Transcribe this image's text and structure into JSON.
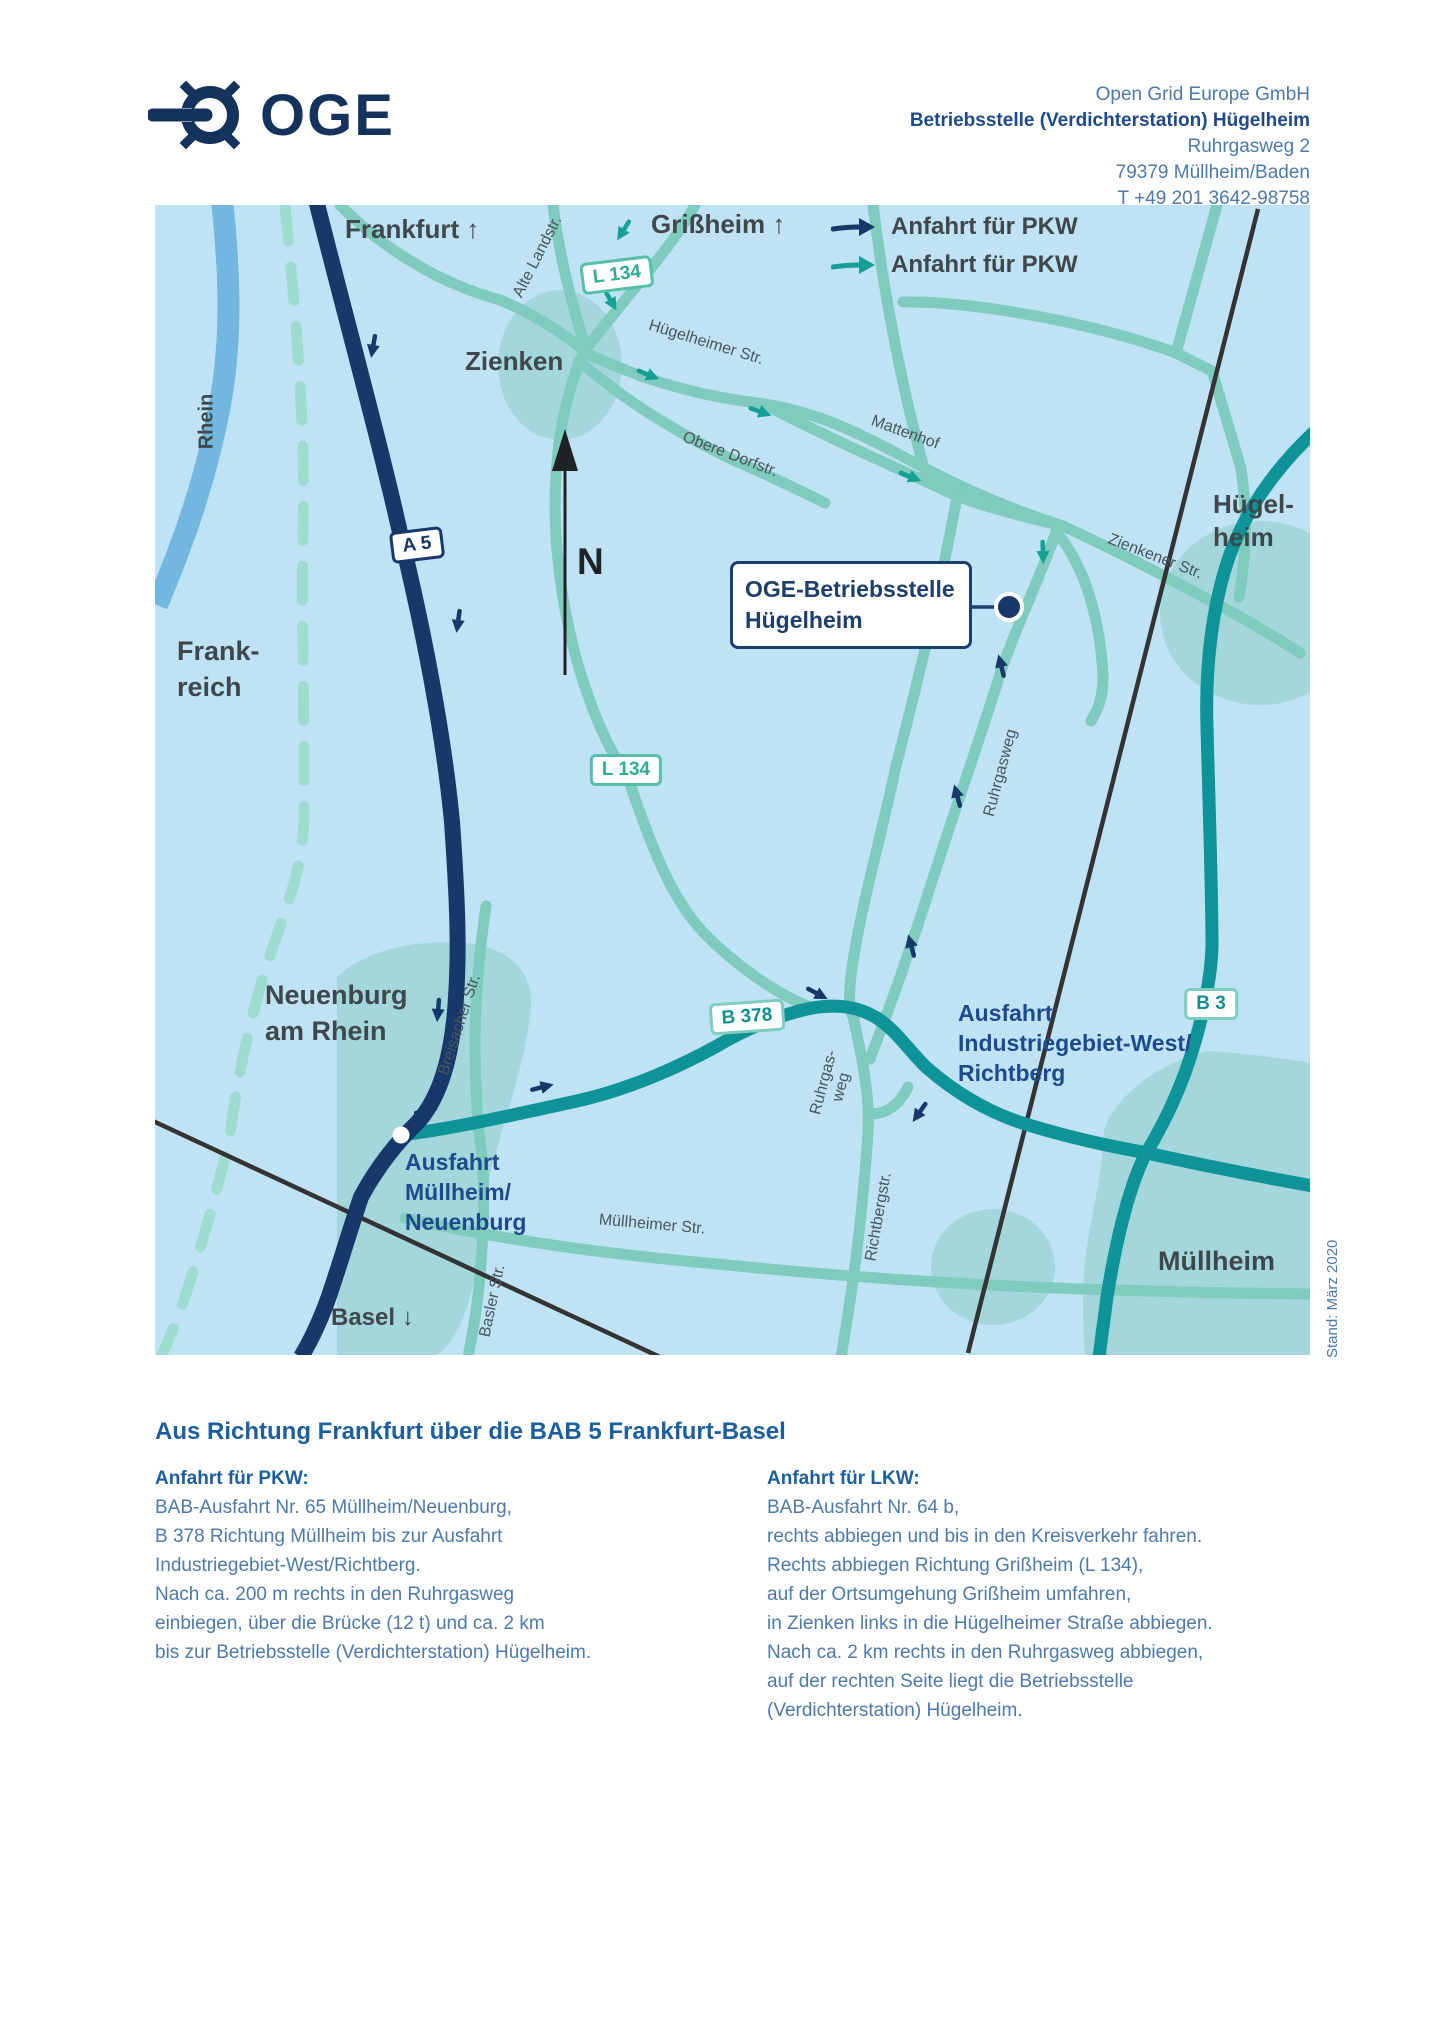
{
  "header": {
    "brand": "OGE",
    "address_lines": [
      "Open Grid Europe GmbH",
      "Betriebsstelle (Verdichterstation) Hügelheim",
      "Ruhrgasweg 2",
      "79379 Müllheim/Baden",
      "T +49 201 3642-98758"
    ]
  },
  "map": {
    "legend": [
      {
        "label": "Anfahrt für PKW",
        "arrow_color": "#16386b"
      },
      {
        "label": "Anfahrt für PKW",
        "arrow_color": "#14a095"
      }
    ],
    "compass": "N",
    "stand_note": "Stand: März 2020",
    "towns": {
      "frankfurt": "Frankfurt ↑",
      "grissheim": "Grißheim ↑",
      "zienken": "Zienken",
      "huegelheim": "Hügel-\nheim",
      "frankreich": "Frank-\nreich",
      "neuenburg": "Neuenburg\nam Rhein",
      "muellheim": "Müllheim",
      "basel": "Basel ↓",
      "rhein": "Rhein"
    },
    "road_badges": [
      {
        "id": "a5",
        "label": "A 5"
      },
      {
        "id": "l134-north",
        "label": "L 134"
      },
      {
        "id": "l134-south",
        "label": "L 134"
      },
      {
        "id": "b378",
        "label": "B 378"
      },
      {
        "id": "b3",
        "label": "B 3"
      }
    ],
    "streets": [
      {
        "id": "alte-landstr",
        "label": "Alte Landstr."
      },
      {
        "id": "huegelheimer-str",
        "label": "Hügelheimer Str."
      },
      {
        "id": "obere-dorfstr",
        "label": "Obere Dorfstr."
      },
      {
        "id": "mattenhof",
        "label": "Mattenhof"
      },
      {
        "id": "zienkener-str",
        "label": "Zienkener Str."
      },
      {
        "id": "ruhrgasweg",
        "label": "Ruhrgasweg"
      },
      {
        "id": "ruhrgas-weg-sued",
        "label": "Ruhrgas-\nweg"
      },
      {
        "id": "richtbergstr",
        "label": "Richtbergstr."
      },
      {
        "id": "breisacher-str",
        "label": "Breisacher Str."
      },
      {
        "id": "basler-str",
        "label": "Basler Str."
      },
      {
        "id": "muellheimer-str",
        "label": "Müllheimer Str."
      }
    ],
    "exits": [
      {
        "id": "ausfahrt-muellheim",
        "label": "Ausfahrt\nMüllheim/\nNeuenburg"
      },
      {
        "id": "ausfahrt-industriegebiet",
        "label": "Ausfahrt\nIndustriegebiet-West/\nRichtberg"
      }
    ],
    "callout": {
      "line1": "OGE-Betriebsstelle",
      "line2": "Hügelheim"
    }
  },
  "directions": {
    "heading": "Aus Richtung Frankfurt über die BAB 5 Frankfurt-Basel",
    "columns": [
      {
        "title": "Anfahrt für PKW:",
        "lines": [
          "BAB-Ausfahrt Nr. 65 Müllheim/Neuenburg,",
          "B 378 Richtung Müllheim bis zur Ausfahrt",
          "Industriegebiet-West/Richtberg.",
          "Nach ca. 200 m rechts in den Ruhrgasweg",
          "einbiegen, über die Brücke (12 t) und ca. 2 km",
          "bis zur Betriebsstelle (Verdichterstation) Hügelheim."
        ]
      },
      {
        "title": "Anfahrt für LKW:",
        "lines": [
          "BAB-Ausfahrt Nr. 64 b,",
          "rechts abbiegen und bis in den Kreisverkehr fahren.",
          "Rechts abbiegen Richtung Grißheim (L 134),",
          "auf der Ortsumgehung Grißheim umfahren,",
          "in Zienken links in die Hügelheimer Straße abbiegen.",
          "Nach ca. 2 km rechts in den Ruhrgasweg abbiegen,",
          "auf der rechten Seite liegt die Betriebsstelle",
          "(Verdichterstation) Hügelheim."
        ]
      }
    ]
  },
  "colors": {
    "map_bg": "#bfe3f4",
    "water": "#72b7e0",
    "town_area": "#a3d7dc",
    "road_light": "#7fcbbd",
    "road_dark_teal": "#0d9398",
    "autobahn_navy": "#16386b",
    "railway": "#333333",
    "border_dash": "#9fdcd0",
    "label_dark": "#3e474b",
    "label_navy": "#1c4a8c",
    "text_blue": "#4d79ab",
    "heading_blue": "#1c5fa0"
  }
}
